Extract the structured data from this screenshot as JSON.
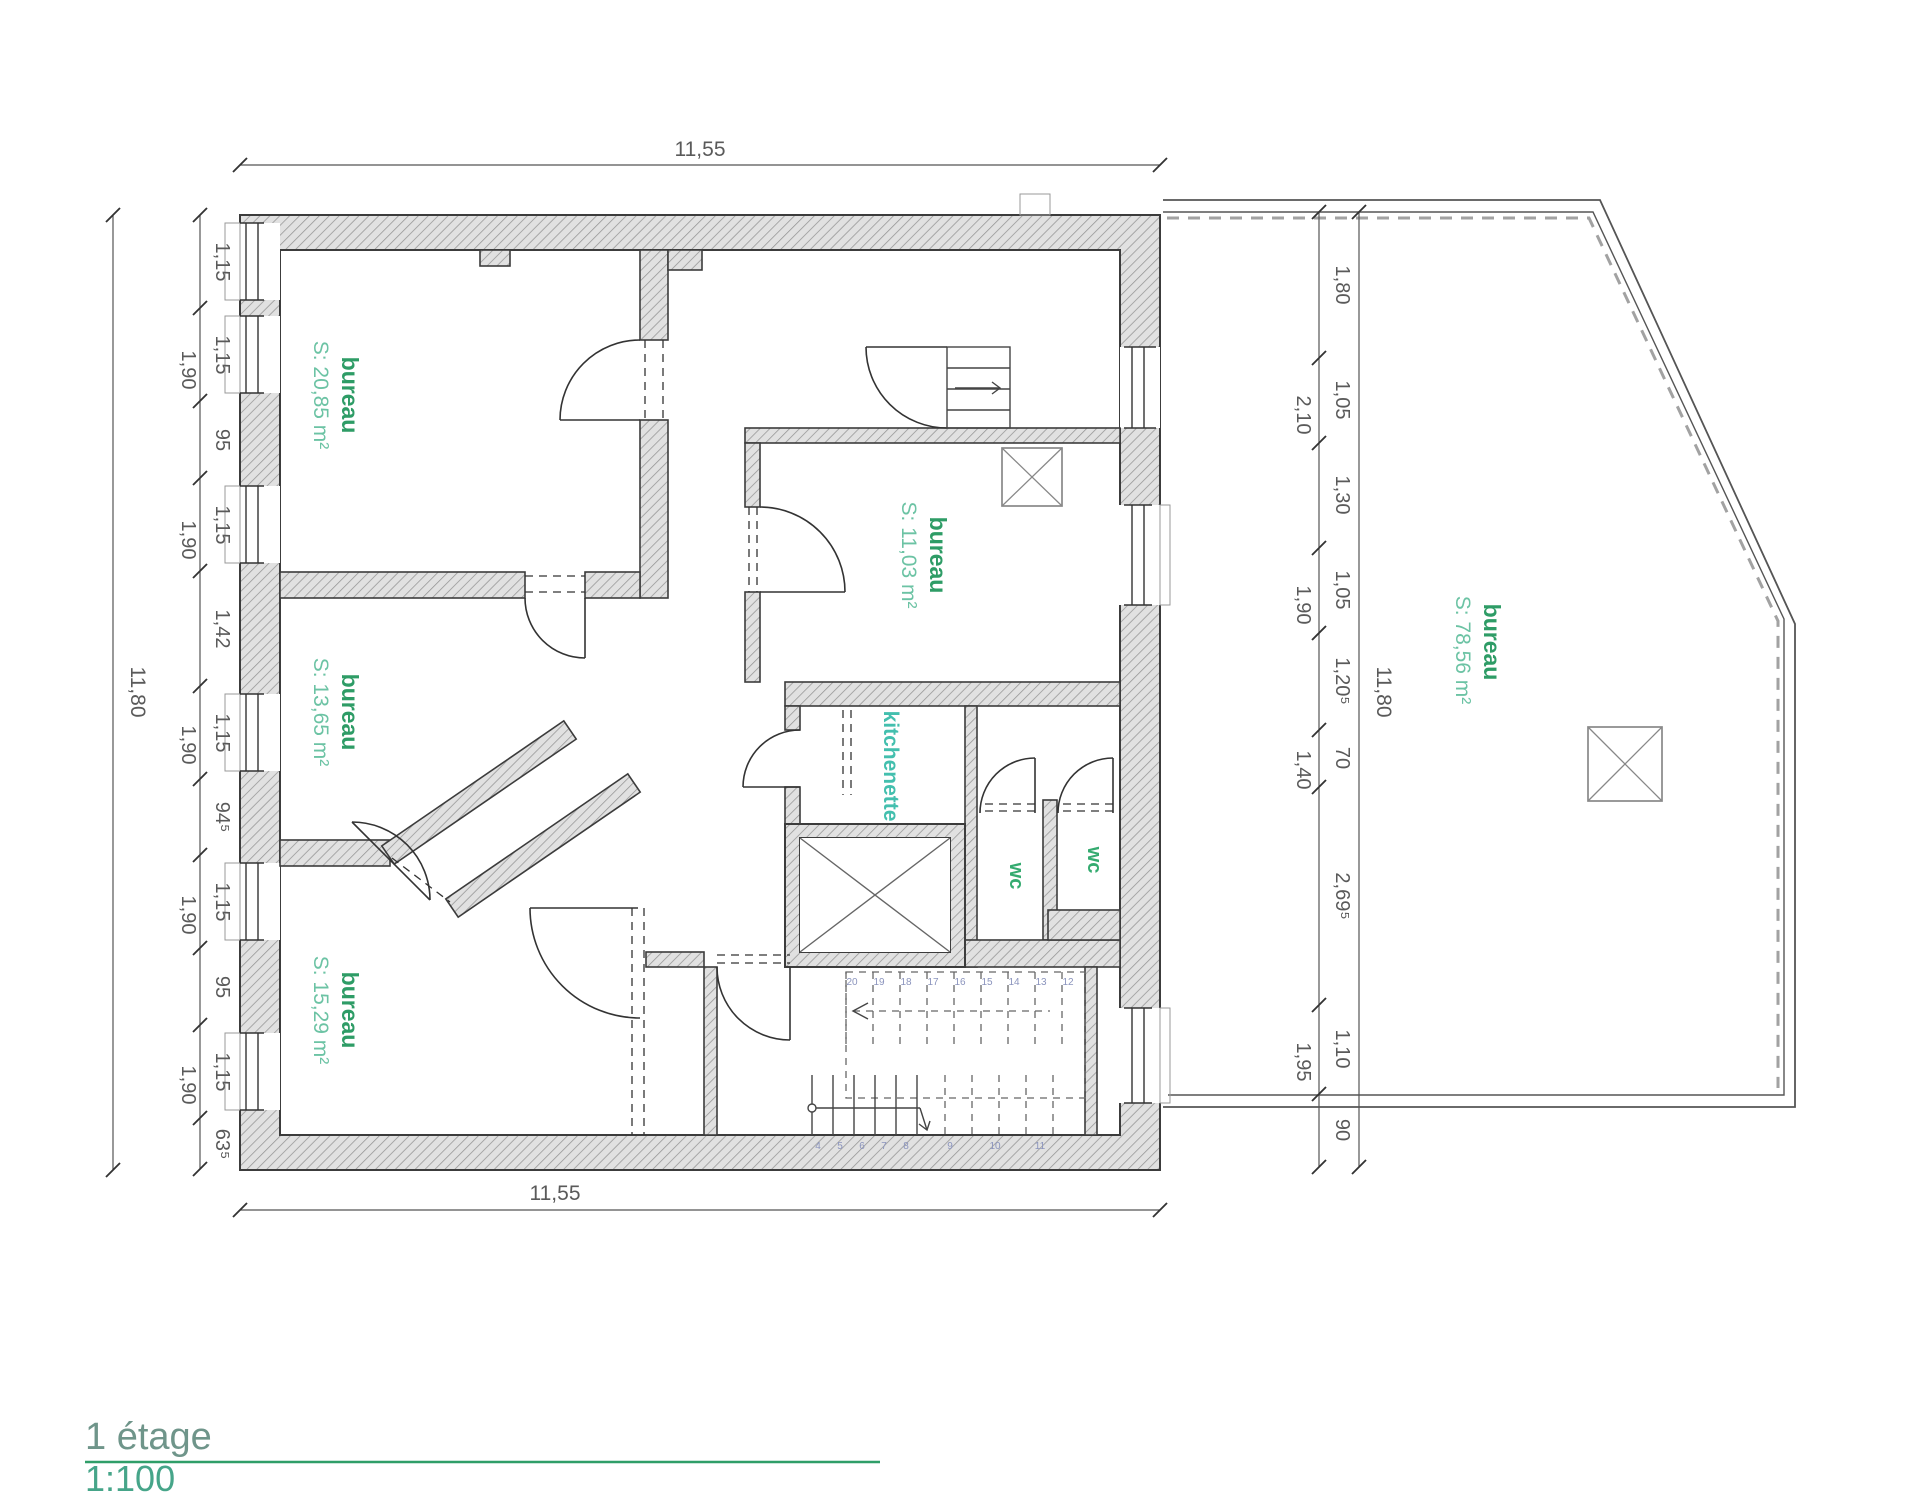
{
  "drawing": {
    "floor_label": "1 étage",
    "scale_label": "1:100"
  },
  "rooms": {
    "bureau_top_left": {
      "name": "bureau",
      "area": "S: 20,85 m²"
    },
    "bureau_mid_left": {
      "name": "bureau",
      "area": "S: 13,65 m²"
    },
    "bureau_bottom_left": {
      "name": "bureau",
      "area": "S: 15,29 m²"
    },
    "bureau_center": {
      "name": "bureau",
      "area": "S: 11,03 m²"
    },
    "bureau_terrace": {
      "name": "bureau",
      "area": "S: 78,56 m²"
    },
    "kitchenette": {
      "name": "kitchenette"
    },
    "wc_left": {
      "name": "wc"
    },
    "wc_right": {
      "name": "wc"
    }
  },
  "dimensions": {
    "top_width": "11,55",
    "bottom_width": "11,55",
    "left_total": "11,80",
    "right_total": "11,80",
    "left_chain": [
      "1,15",
      "1,15",
      "95",
      "1,15",
      "1,42",
      "1,15",
      "94⁵",
      "1,15",
      "95",
      "1,15",
      "63⁵"
    ],
    "left_axis": [
      "1,90",
      "1,90",
      "1,90",
      "1,90",
      "1,90"
    ],
    "mid_chain": [
      "1,80",
      "1,05",
      "1,30",
      "1,05",
      "1,20⁵",
      "70",
      "2,69⁵",
      "1,10",
      "90"
    ],
    "mid_axis": [
      "2,10",
      "1,90",
      "1,40",
      "1,95"
    ]
  },
  "stairs": {
    "upper_run_numbers": [
      "20",
      "19",
      "18",
      "17",
      "16",
      "15",
      "14",
      "13",
      "12"
    ],
    "lower_run_numbers": [
      "4",
      "5",
      "6",
      "7",
      "8",
      "9",
      "10",
      "11"
    ]
  },
  "colors": {
    "room_name": "#2e9c66",
    "room_area": "#6cc3a4",
    "kitchenette_label": "#43bfae",
    "wc_label": "#35ab70",
    "title_underline": "#2f9e68",
    "dimension_text": "#5a5a5a"
  }
}
